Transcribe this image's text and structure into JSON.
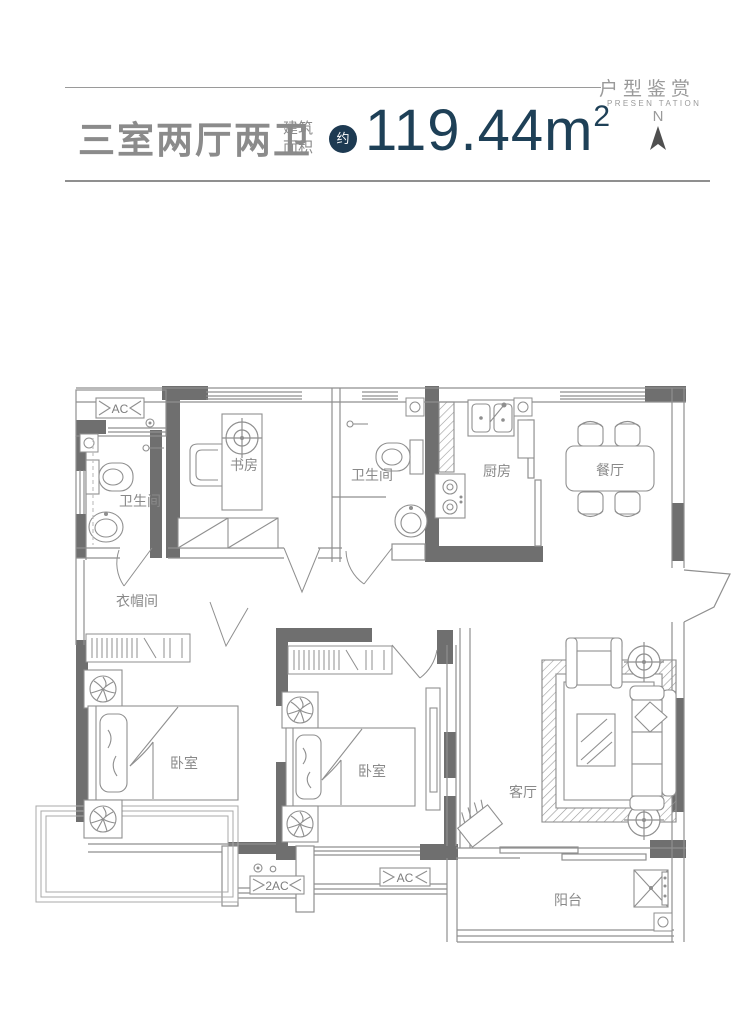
{
  "brand": {
    "title": "户型鉴赏",
    "subtitle": "PRESEN TATION"
  },
  "header": {
    "title": "三室两厅两卫",
    "area_label_line1": "建筑",
    "area_label_line2": "面积",
    "approx_badge": "约",
    "area_value": "119.44",
    "area_unit": "m",
    "area_exponent": "2",
    "compass_label": "N"
  },
  "rooms": {
    "bathroom_1": "卫生间",
    "study": "书房",
    "bathroom_2": "卫生间",
    "kitchen": "厨房",
    "dining": "餐厅",
    "cloakroom": "衣帽间",
    "bedroom_1": "卧室",
    "bedroom_2": "卧室",
    "living": "客厅",
    "balcony": "阳台"
  },
  "equipment": {
    "ac_top": "AC",
    "ac_mid": "AC",
    "ac_double": "2AC"
  },
  "colors": {
    "accent_navy": "#1d3a52",
    "area_text_navy": "#1e4057",
    "wall_gray": "#6f6f6f",
    "line_gray": "#8f8f8f",
    "text_gray": "#8b8b8b"
  }
}
